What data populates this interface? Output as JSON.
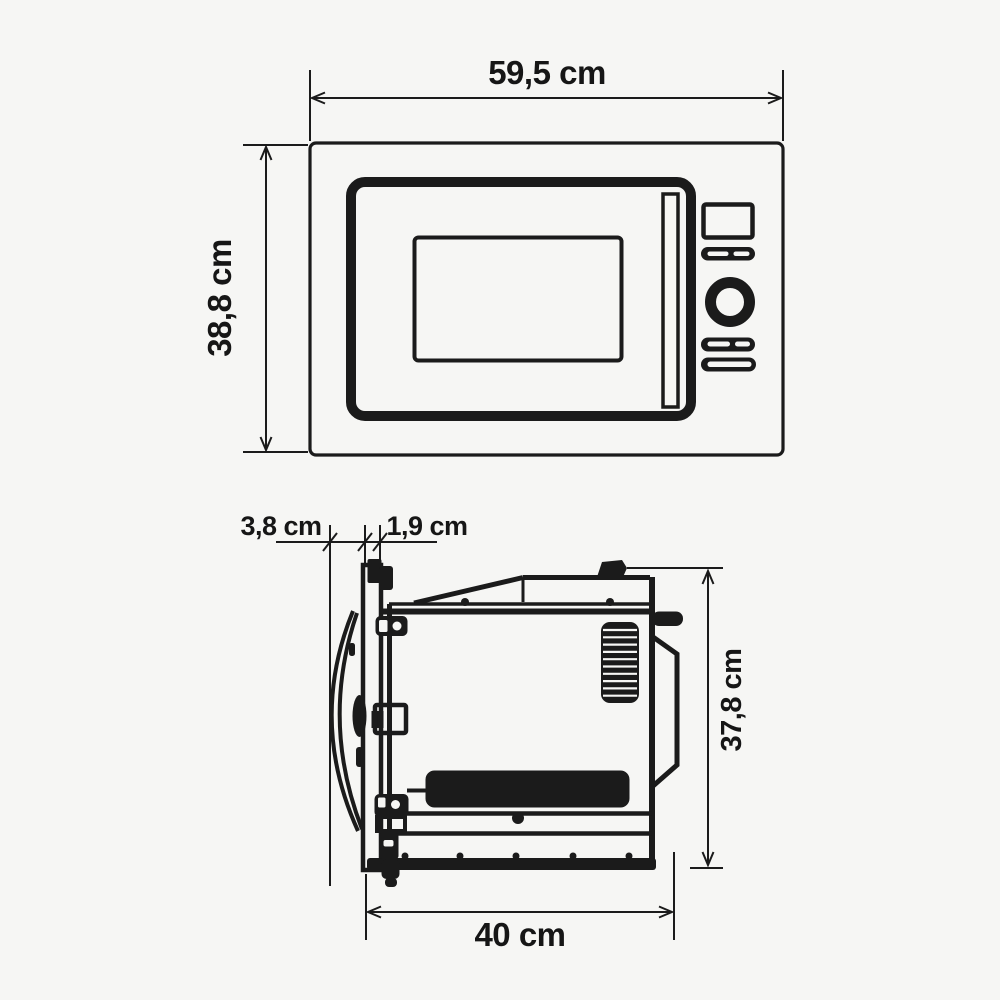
{
  "page": {
    "background_color": "#f6f6f4",
    "line_color": "#1b1b1b",
    "description": "Built-in microwave oven dimension drawing, front view and side view"
  },
  "diagram": {
    "front_view": {
      "width_label": "59,5 cm",
      "width_value_cm": 59.5,
      "height_label": "38,8 cm",
      "height_value_cm": 38.8
    },
    "side_view": {
      "door_protrusion_label": "3,8 cm",
      "door_protrusion_value_cm": 3.8,
      "frame_depth_label": "1,9 cm",
      "frame_depth_value_cm": 1.9,
      "height_label": "37,8 cm",
      "height_value_cm": 37.8,
      "depth_label": "40 cm",
      "depth_value_cm": 40
    }
  }
}
